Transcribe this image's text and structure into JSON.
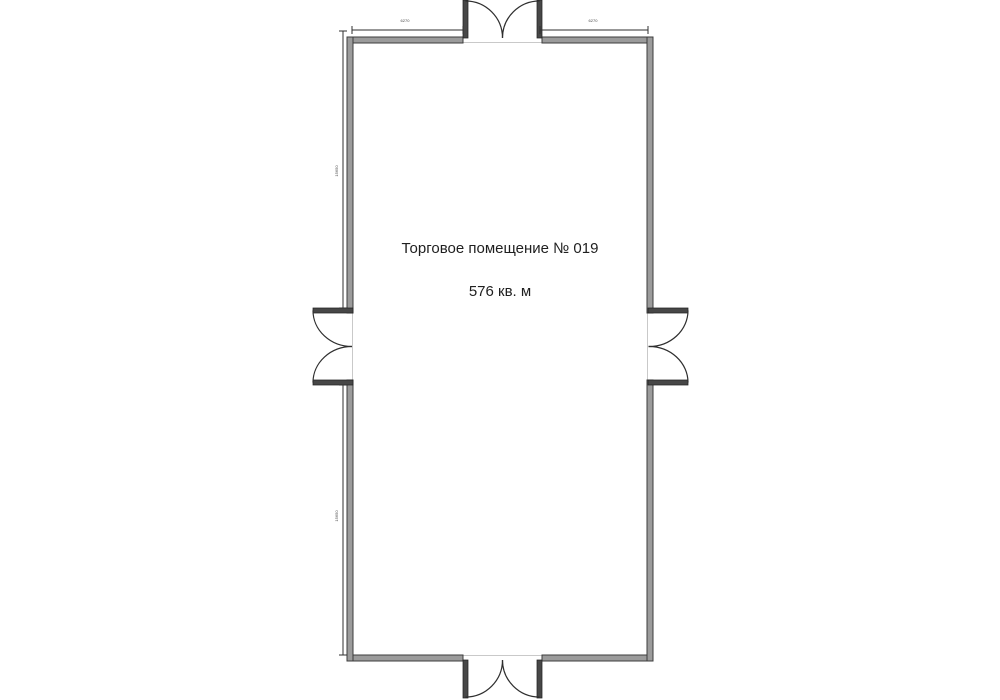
{
  "room": {
    "title": "Торговое помещение № 019",
    "area": "576 кв. м"
  },
  "dimensions": {
    "top_left": "6270",
    "top_right": "6270",
    "left_upper": "15650",
    "left_lower": "15650"
  },
  "colors": {
    "page_bg": "#ffffff",
    "wall_fill": "#9b9b9b",
    "wall_edge": "#3c3c3c",
    "door_leaf": "#474747",
    "arc_line": "#2f2f2f",
    "dim_line": "#2f2f2f",
    "threshold": "#c9c9c9",
    "text_color": "#1f1f1f",
    "dim_text": "#4a4a4a"
  }
}
